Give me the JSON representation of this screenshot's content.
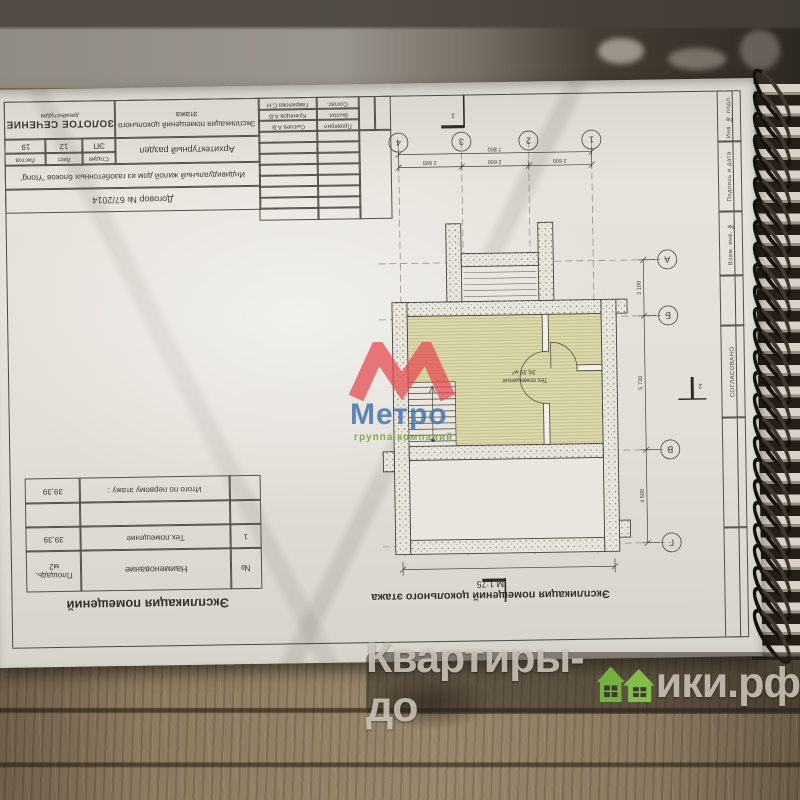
{
  "watermarks": {
    "site_prefix": "Квартиры-до",
    "site_suffix": "ики.рф",
    "site_full": "Квартиры-домики.рф",
    "metro_name": "Метро",
    "metro_tagline": "группа компаний",
    "colors": {
      "house_green": "#7cb342",
      "metro_red": "#e5484d",
      "metro_blue": "#4a78b0",
      "metro_green": "#76a33e"
    }
  },
  "sheet": {
    "stamp": {
      "logo_small": "дизайнстудия",
      "logo_name": "ЗОЛОТОЕ СЕЧЕНИЕ",
      "stage_values": [
        "19",
        "12",
        "ЭП"
      ],
      "stage_labels": [
        "Листов",
        "Лист",
        "Стадия"
      ],
      "doc_title_line1": "Экспликация помещений цокольного",
      "doc_title_line2": "этажа",
      "section_name": "Архитектурный раздел",
      "object_name": "Индивидуальный жилой дом из газобетонных блоков 'Ytong'",
      "contract": "Договор № 67/2014",
      "signers": [
        {
          "name": "Гаврилова С.Н",
          "role": "Соглас."
        },
        {
          "name": "Кузнецов А.В",
          "role": "Выпол."
        },
        {
          "name": "Сысоев А.В",
          "role": "Проверил"
        }
      ],
      "side_fields": [
        "Инв. № подл.",
        "Подпись и дата",
        "Взам. инв. №",
        "СОГЛАСОВАНО"
      ]
    },
    "explication": {
      "title": "Экспликация помещений",
      "col_area": "Площадь, м2",
      "col_name": "Наименование",
      "col_num": "№",
      "row1": {
        "num": "1",
        "name": "Тех.помещение",
        "area": "39,39"
      },
      "total_label": "Итого по первому этажу :",
      "total_area": "39,39"
    },
    "caption": {
      "title": "Экспликация помещений цокольного этажа",
      "scale": "М 1:75"
    },
    "plan": {
      "room_name": "Тех.помещение",
      "room_area": "39,39 м²",
      "axes_top": [
        "4",
        "3",
        "2",
        "1"
      ],
      "axes_right": [
        "А",
        "Б",
        "В",
        "Г"
      ],
      "dim_total_top": "7 800",
      "dim_bays_top": [
        "2 600",
        "2 600",
        "2 600"
      ],
      "dims_right": [
        "2 100",
        "5 730",
        "4 500"
      ],
      "section_mark_1": "1",
      "section_mark_2": "2"
    }
  }
}
